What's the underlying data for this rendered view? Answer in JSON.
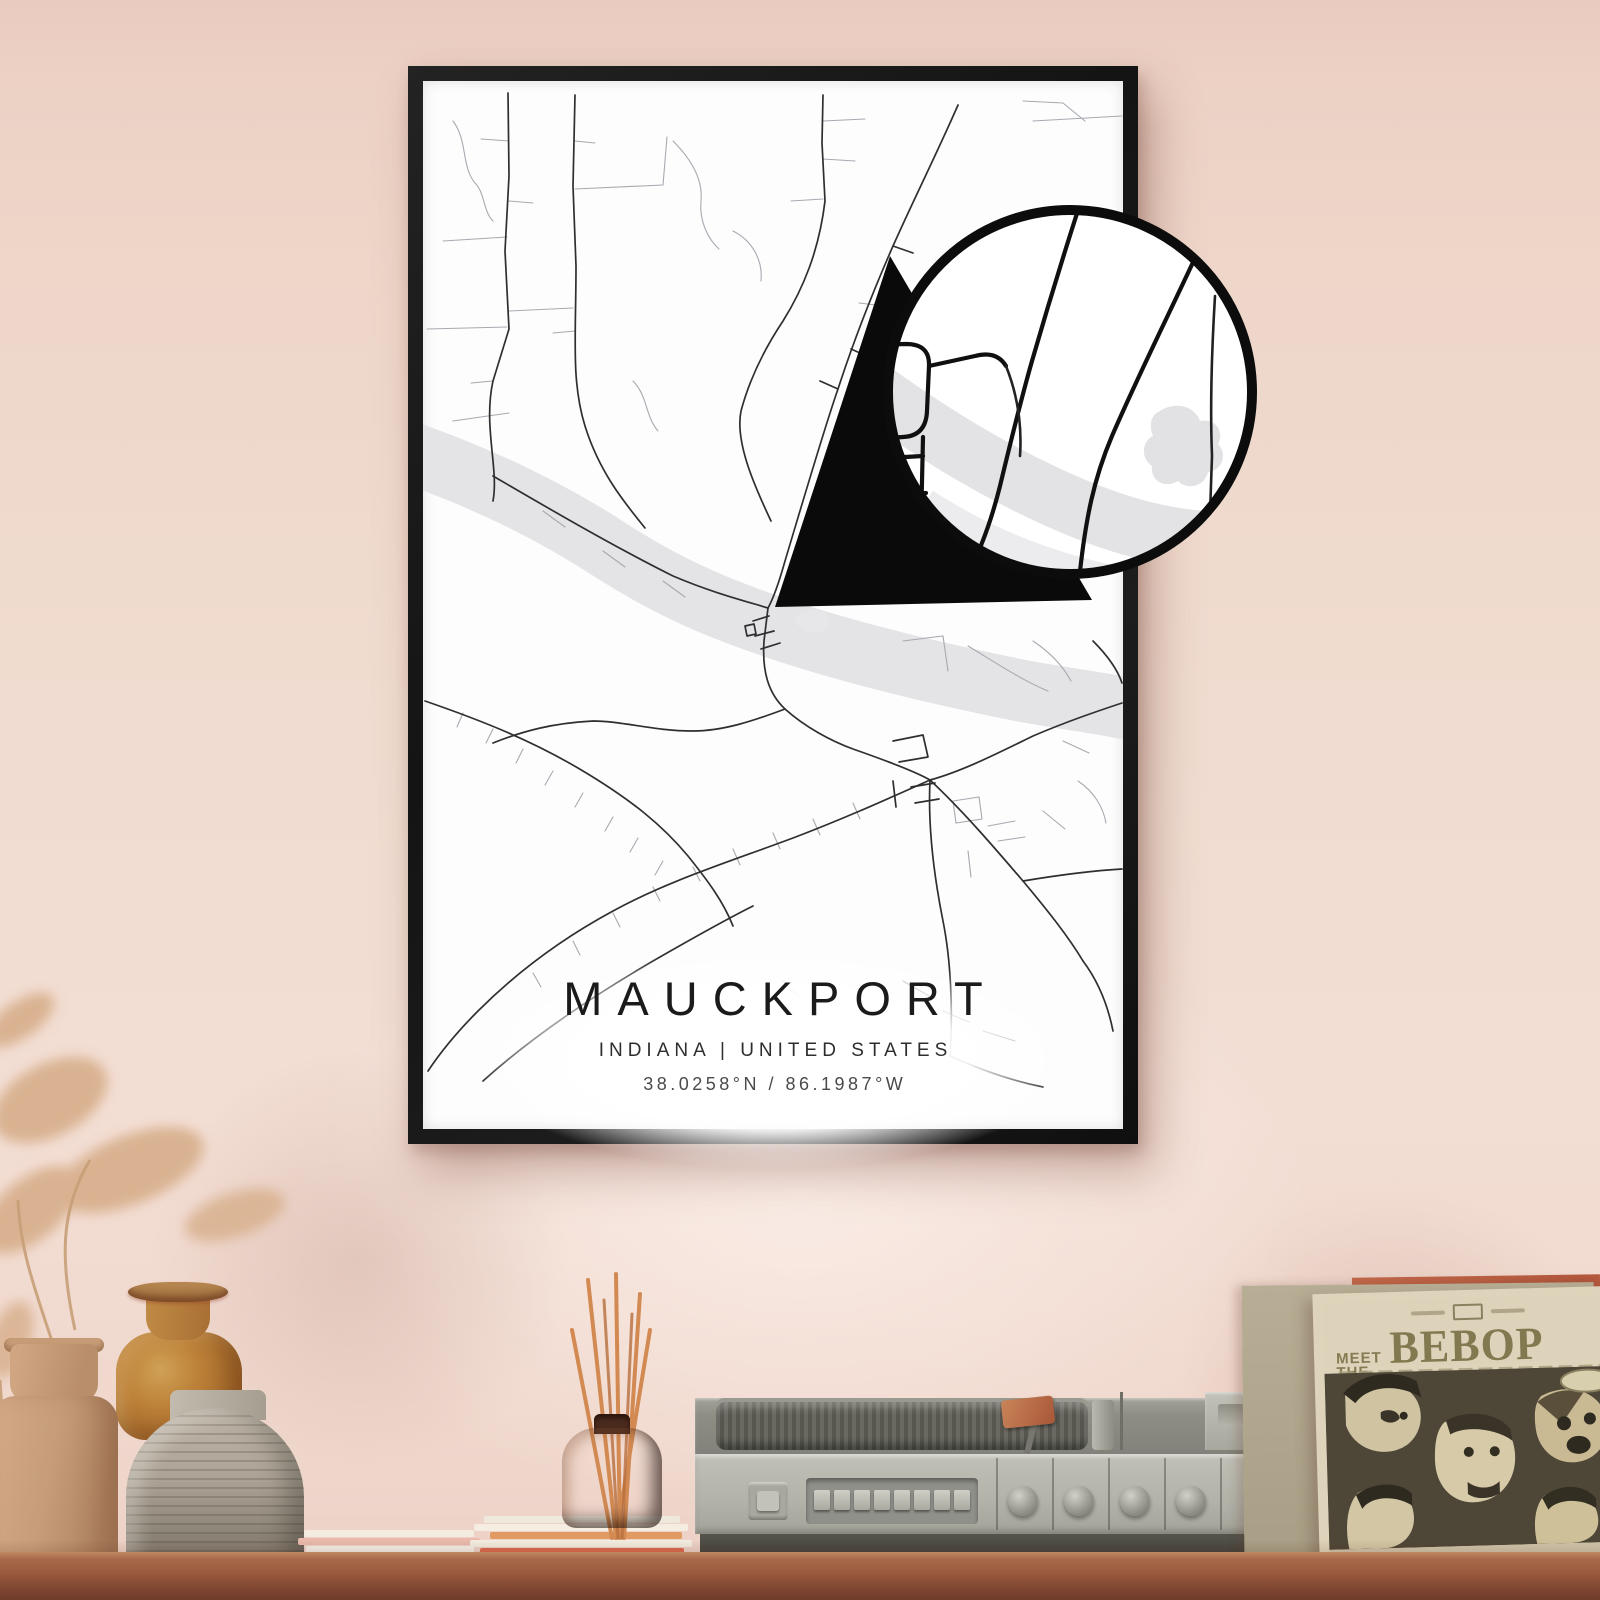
{
  "poster": {
    "title": "MAUCKPORT",
    "subtitle": "INDIANA | UNITED STATES",
    "coordinates": "38.0258°N / 86.1987°W"
  },
  "album": {
    "pretitle_top": "MEET",
    "pretitle_bottom": "THE",
    "title": "BEBOP"
  },
  "colors": {
    "wall": "#eed6ca",
    "frame": "#171717",
    "poster_paper": "#fdfdfd",
    "river": "#e4e4e7",
    "road_major": "#2f2f30",
    "road_minor": "#a6aab0",
    "lens_ink": "#0c0c0c",
    "shelf_wood": "#9c5f43",
    "reed_sticks": "#d28a52",
    "album_ink": "#857a52",
    "album_art_bg": "#4e4737"
  }
}
